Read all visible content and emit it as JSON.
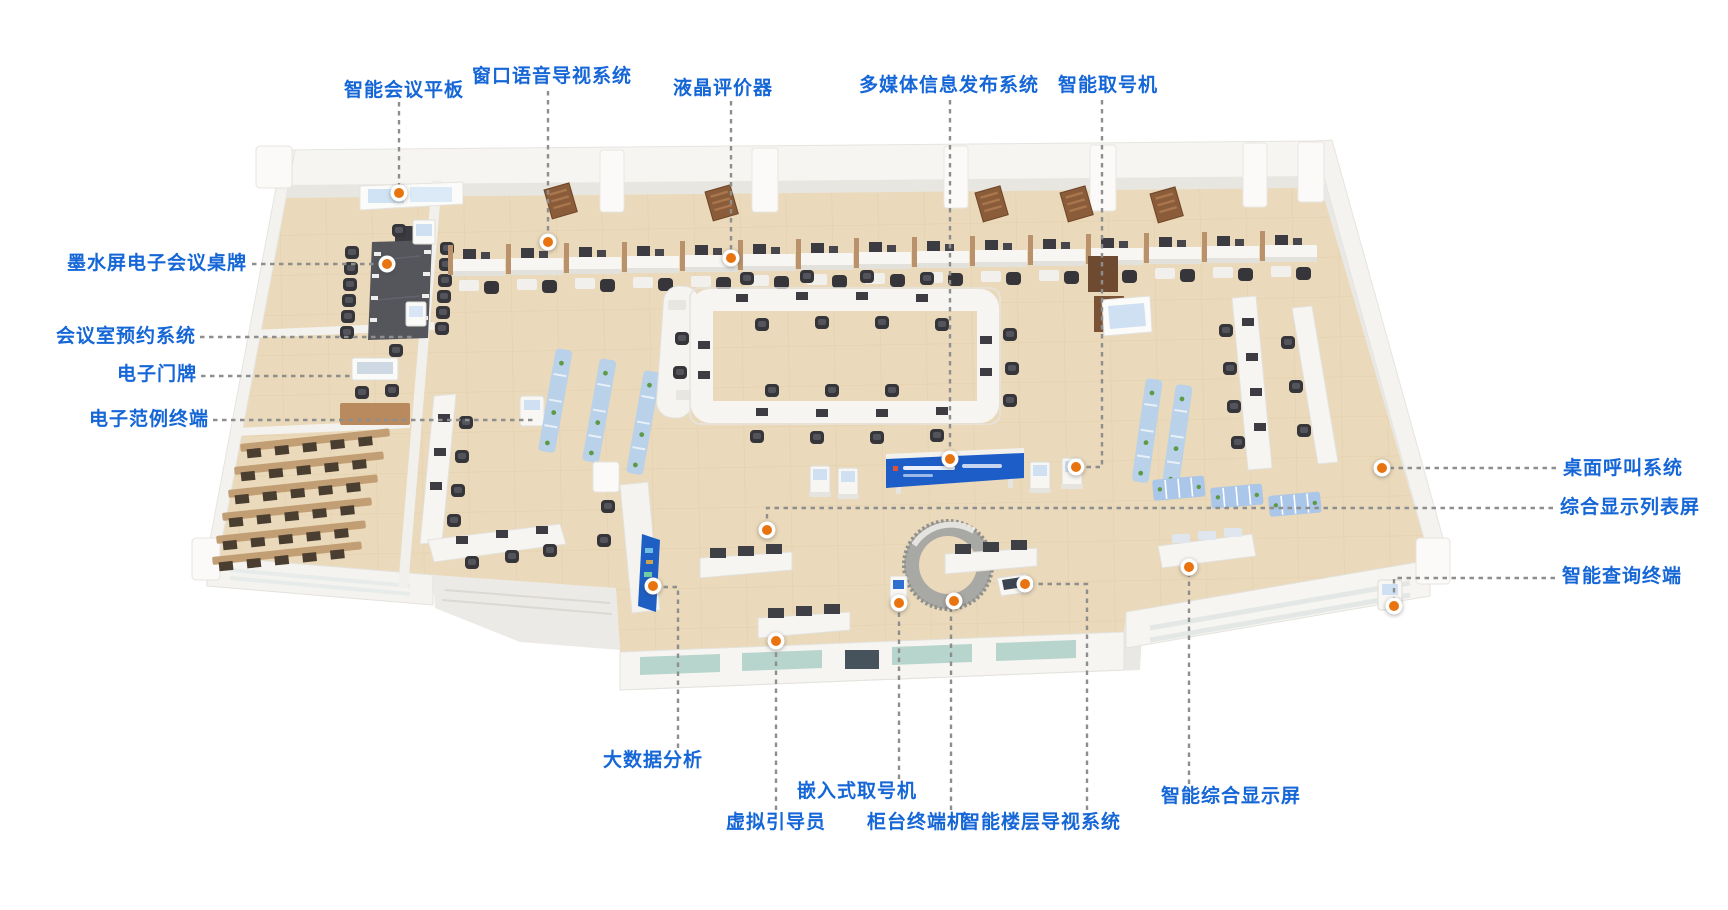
{
  "diagram_title": "智慧营业厅平面示意图",
  "colors": {
    "label_text": "#1566d6",
    "connector_dash": "#8e8e8e",
    "hotspot_orange": "#e8730f",
    "floor_beige": "#ead9ba",
    "wall_white": "#f6f5f2",
    "banner_blue": "#1d5dc8",
    "bench_blue": "#aac6e8",
    "door_wood": "#8a5c39",
    "chair_dark": "#35353a"
  },
  "labels": [
    {
      "id": "smart-meeting-panel",
      "text": "智能会议平板"
    },
    {
      "id": "window-voice-guidance",
      "text": "窗口语音导视系统"
    },
    {
      "id": "lcd-evaluator",
      "text": "液晶评价器"
    },
    {
      "id": "multimedia-info-publishing",
      "text": "多媒体信息发布系统"
    },
    {
      "id": "smart-ticket-dispenser",
      "text": "智能取号机"
    },
    {
      "id": "eink-conference-card",
      "text": "墨水屏电子会议桌牌"
    },
    {
      "id": "meeting-room-reservation",
      "text": "会议室预约系统"
    },
    {
      "id": "electronic-doorplate",
      "text": "电子门牌"
    },
    {
      "id": "electronic-sample-terminal",
      "text": "电子范例终端"
    },
    {
      "id": "desktop-calling-system",
      "text": "桌面呼叫系统"
    },
    {
      "id": "comprehensive-list-display",
      "text": "综合显示列表屏"
    },
    {
      "id": "smart-query-terminal",
      "text": "智能查询终端"
    },
    {
      "id": "big-data-analysis",
      "text": "大数据分析"
    },
    {
      "id": "virtual-guide",
      "text": "虚拟引导员"
    },
    {
      "id": "embedded-ticket-dispenser",
      "text": "嵌入式取号机"
    },
    {
      "id": "counter-terminal",
      "text": "柜台终端机"
    },
    {
      "id": "smart-floor-guidance",
      "text": "智能楼层导视系统"
    },
    {
      "id": "smart-comprehensive-display",
      "text": "智能综合显示屏"
    }
  ],
  "scene_objects": [
    "meeting-room",
    "conference-table",
    "wall-mounted-meeting-screen",
    "teller-cubicle-row",
    "waiting-bench-rows",
    "entrance-apron",
    "center-ring-counter",
    "led-banner",
    "ticket-kiosks",
    "circular-service-desk",
    "virtual-guide-kiosk",
    "floor-guidance-device",
    "blue-waiting-benches",
    "data-screen-panel",
    "query-terminal-kiosk",
    "bottom-display-counters",
    "right-wall-counters",
    "wood-doors"
  ]
}
